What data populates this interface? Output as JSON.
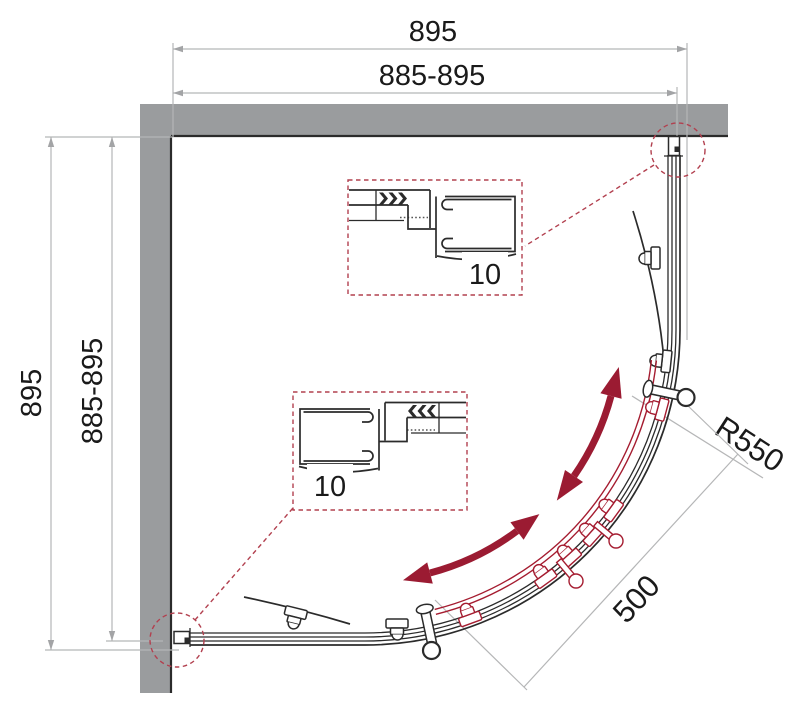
{
  "title": "Quadrant shower enclosure — dimensioned plan drawing",
  "labels": {
    "dim_top_overall": "895",
    "dim_top_adjustable": "885-895",
    "dim_left_overall": "895",
    "dim_left_adjustable": "885-895",
    "radius": "R550",
    "opening": "500",
    "detail_top": "10",
    "detail_bottom": "10"
  },
  "colors": {
    "wall_gray": "#9a9c9e",
    "drawing_outline": "#2b2b2b",
    "dimension_gray": "#b5b6b7",
    "door_red": "#a51c30",
    "callout_dashed_red": "#b2404f",
    "arrow_crimson": "#9b1b32",
    "text": "#1a1a1a"
  }
}
